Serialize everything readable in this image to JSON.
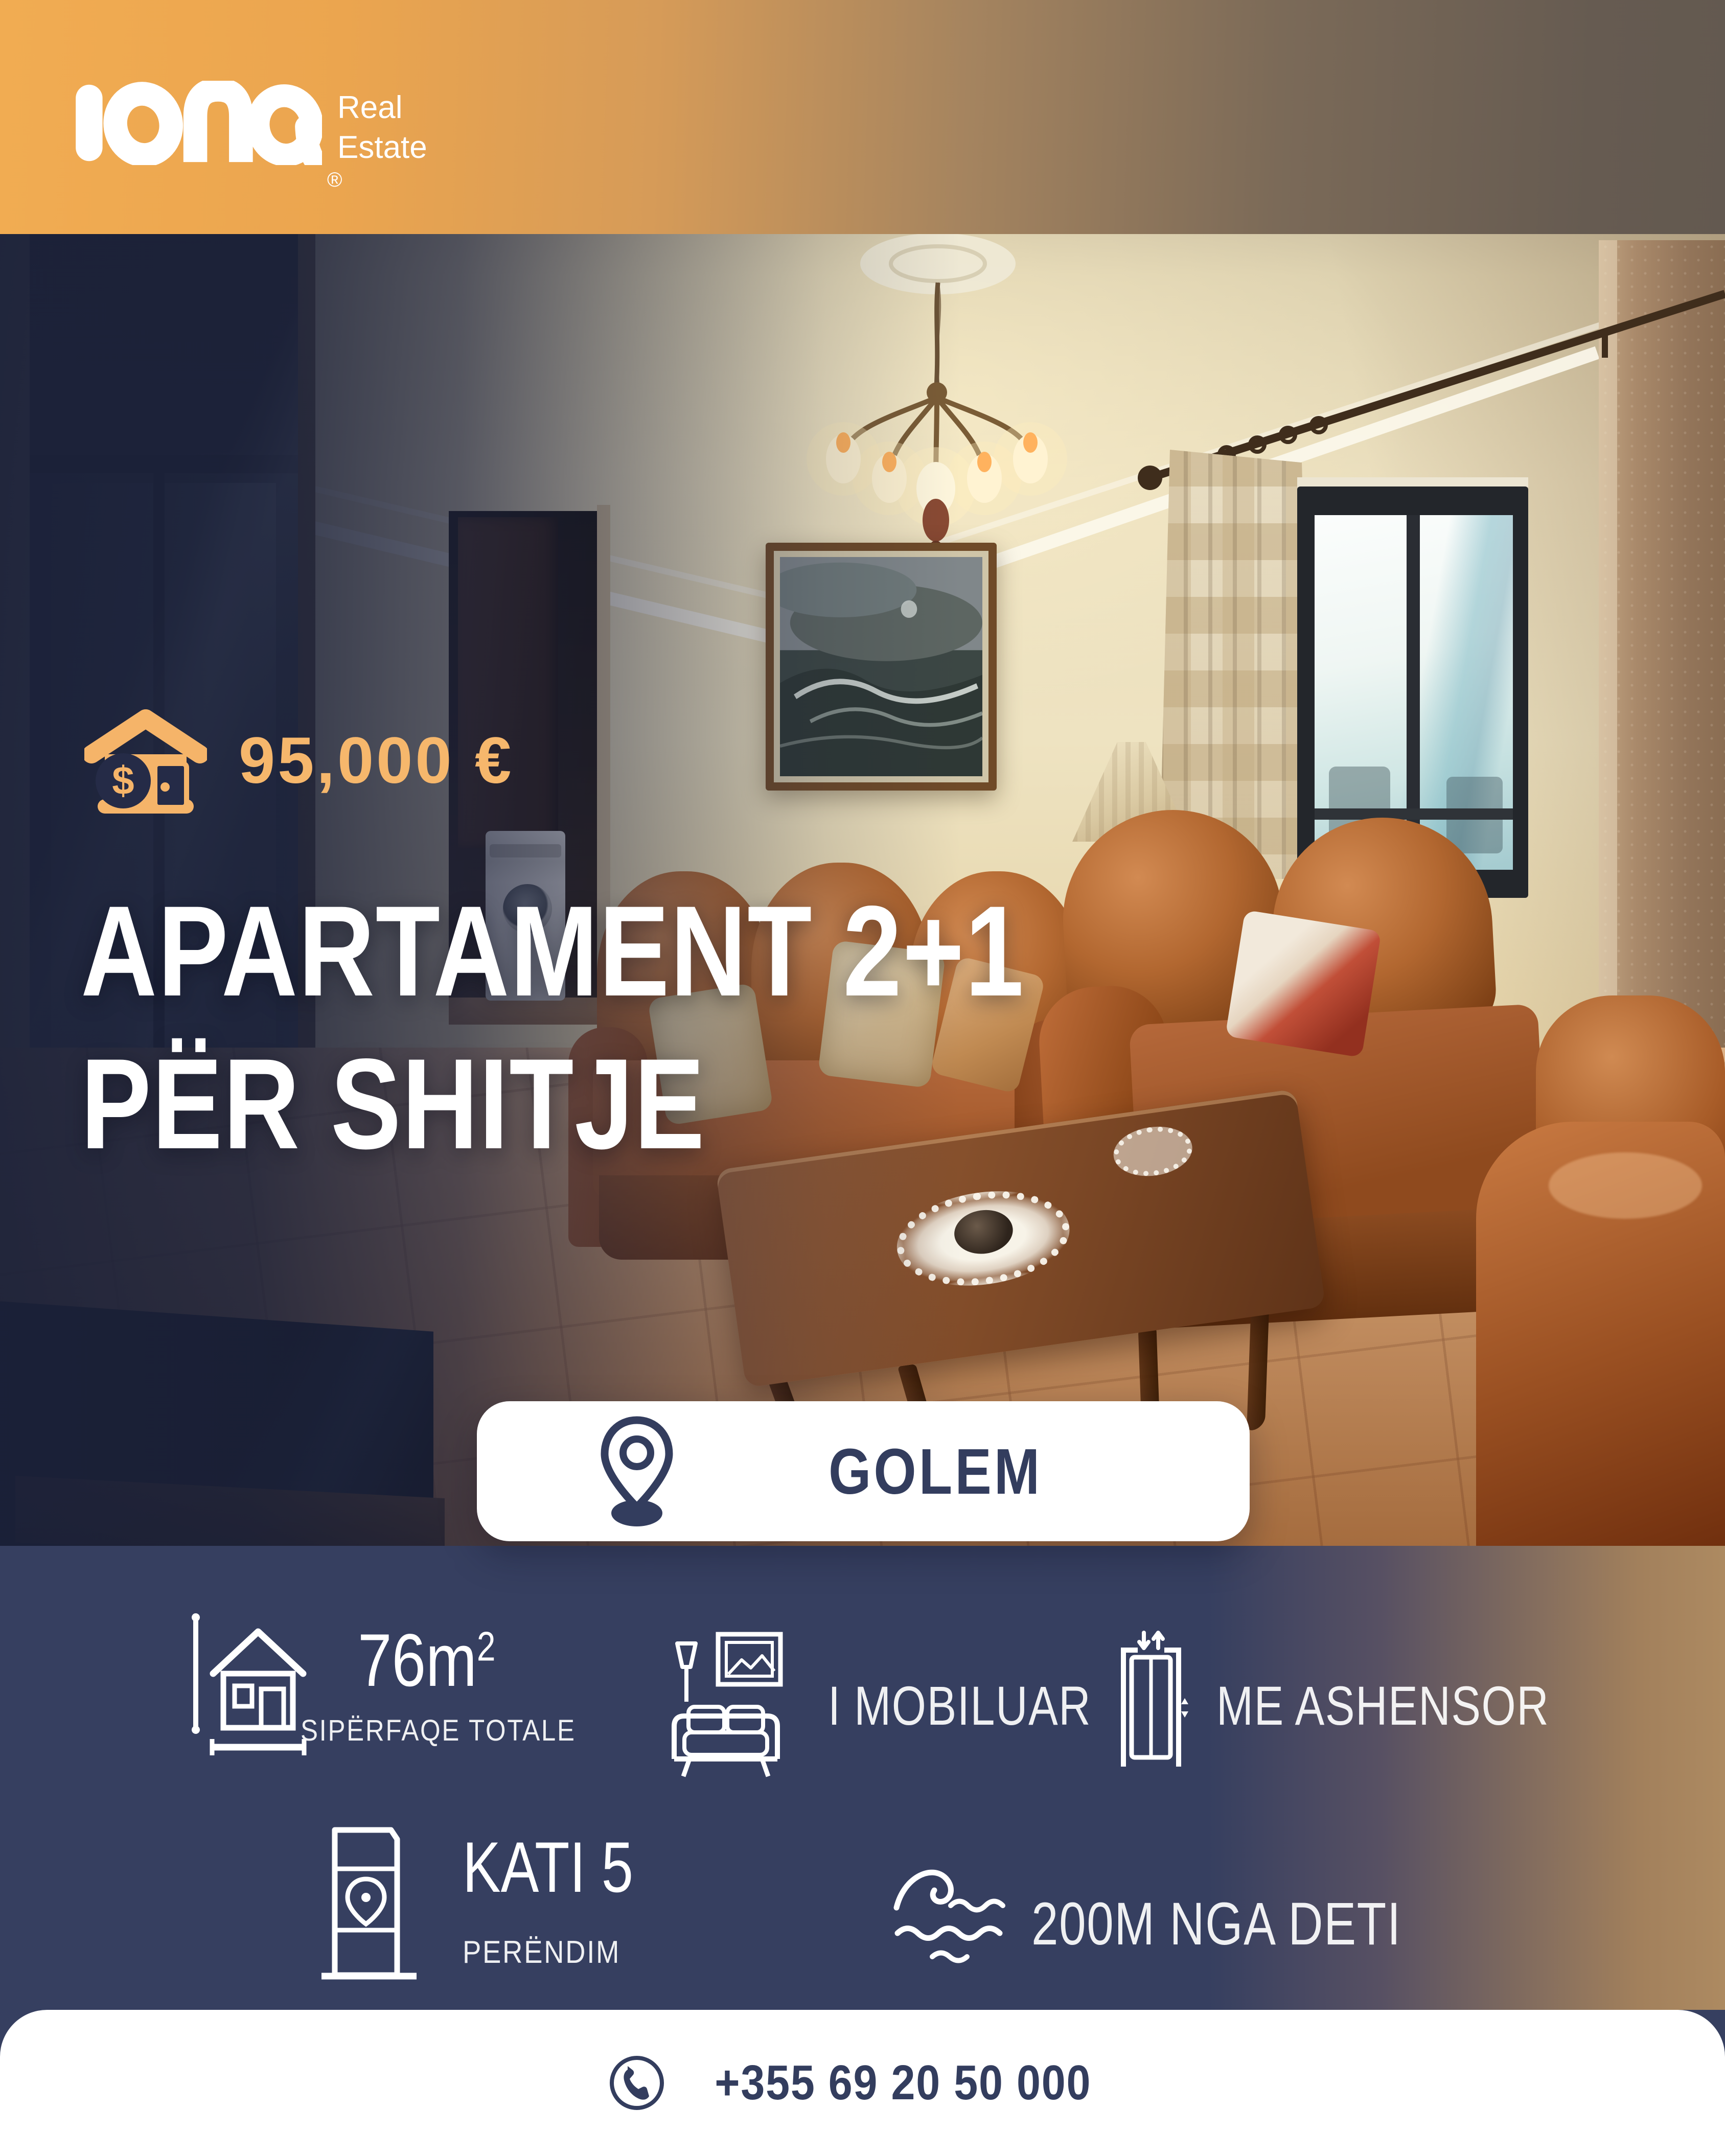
{
  "brand": {
    "logo_text": "iona",
    "tagline_line1": "Real",
    "tagline_line2": "Estate",
    "registered_mark": "®"
  },
  "listing": {
    "price": "95,000 €",
    "title_line1": "APARTAMENT 2+1",
    "title_line2": "PËR SHITJE",
    "location": "GOLEM"
  },
  "features": {
    "area_value": "76m",
    "area_sup": "2",
    "area_label": "SIPËRFAQE TOTALE",
    "furnished_label": "I MOBILUAR",
    "elevator_label": "ME ASHENSOR",
    "floor_value": "KATI 5",
    "floor_label": "PERËNDIM",
    "sea_label": "200M NGA DETI"
  },
  "contact": {
    "phone": "+355 69 20 50 000"
  },
  "icons": {
    "dollar": "$"
  },
  "colors": {
    "accent_orange": "#f6b76c",
    "gold": "#eca54e",
    "navy_panel": "#363f60",
    "navy_text": "#333d5e",
    "tan": "#a8855e",
    "white": "#ffffff"
  }
}
